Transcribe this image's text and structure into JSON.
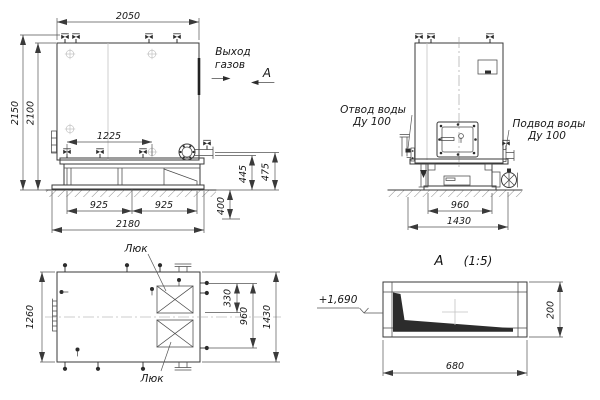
{
  "colors": {
    "line": "#3a3a3a",
    "dimension_line": "#555555",
    "text": "#161616",
    "hatch_fill": "#2c2c2c",
    "background": "#ffffff"
  },
  "front_view": {
    "dim_width_top": "2050",
    "dim_height_overall": "2150",
    "dim_height_body": "2100",
    "dim_burner_axis": "1225",
    "dim_base_span_left": "925",
    "dim_base_span_right": "925",
    "dim_base_width": "2180",
    "dim_pipe_height_a": "445",
    "dim_pipe_height_b": "475",
    "dim_foundation_depth": "400",
    "gas_outlet_line1": "Выход",
    "gas_outlet_line2": "газов",
    "section_mark": "А"
  },
  "side_view": {
    "water_outlet_line1": "Отвод воды",
    "water_outlet_line2": "Ду 100",
    "water_inlet_line1": "Подвод воды",
    "water_inlet_line2": "Ду 100",
    "dim_base_width": "960",
    "dim_overall_width": "1430"
  },
  "top_view": {
    "hatch_label_top": "Люк",
    "hatch_label_bottom": "Люк",
    "dim_depth": "1260",
    "dim_hatch_offset": "330",
    "dim_hatch_span": "960",
    "dim_overall": "1430"
  },
  "detail_view": {
    "title": "А",
    "scale": "(1:5)",
    "elevation": "+1,690",
    "dim_width": "680",
    "dim_height": "200"
  }
}
